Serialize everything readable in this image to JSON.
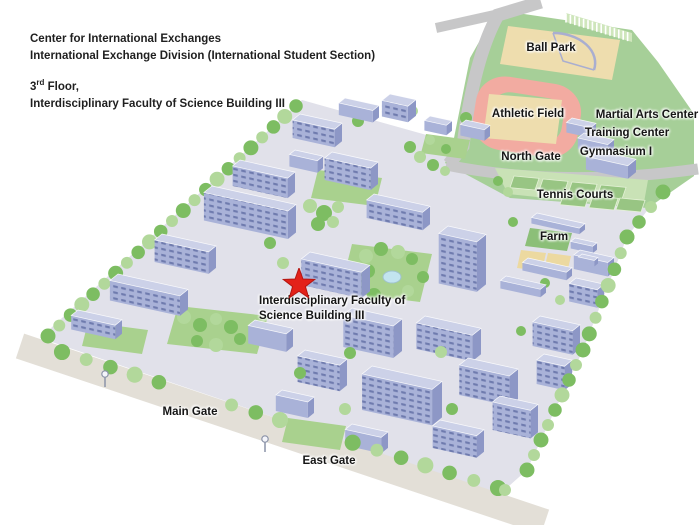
{
  "header": {
    "line1": "Center for International Exchanges",
    "line2": "International Exchange Division (International Student Section)",
    "floor_number": "3",
    "floor_ordinal": "rd",
    "floor_rest": " Floor,",
    "line4": "Interdisciplinary Faculty of Science Building III"
  },
  "map": {
    "labels": {
      "ball_park": "Ball Park",
      "athletic_field": "Athletic Field",
      "martial_arts_center": "Martial Arts Center",
      "training_center": "Training Center",
      "gymnasium_1": "Gymnasium I",
      "north_gate": "North Gate",
      "tennis_courts": "Tennis Courts",
      "farm": "Farm",
      "highlight_building": "Interdisciplinary Faculty of Science Building III",
      "main_gate": "Main Gate",
      "east_gate": "East Gate"
    },
    "marker": "red-star"
  },
  "colors": {
    "ground": "#e1e1ea",
    "building_top": "#ccd1e8",
    "building_front": "#a9b2d8",
    "building_side": "#8d97c6",
    "window": "#6f7bae",
    "tree_dark": "#7dbd62",
    "tree_light": "#b2d89b",
    "grass": "#a9d18e",
    "sports_green": "#a6cf98",
    "courts_band": "#c9e2b6",
    "court_green": "#98c583",
    "field_tan": "#eeddae",
    "track_pink": "#f2aba1",
    "road_gray": "#c7c7c8",
    "road_tan": "#e3dfd7",
    "pond_blue": "#c2e4ef",
    "diamond_lavender": "#a9aed0",
    "star_red": "#e32119",
    "text": "#1f1f1f"
  }
}
